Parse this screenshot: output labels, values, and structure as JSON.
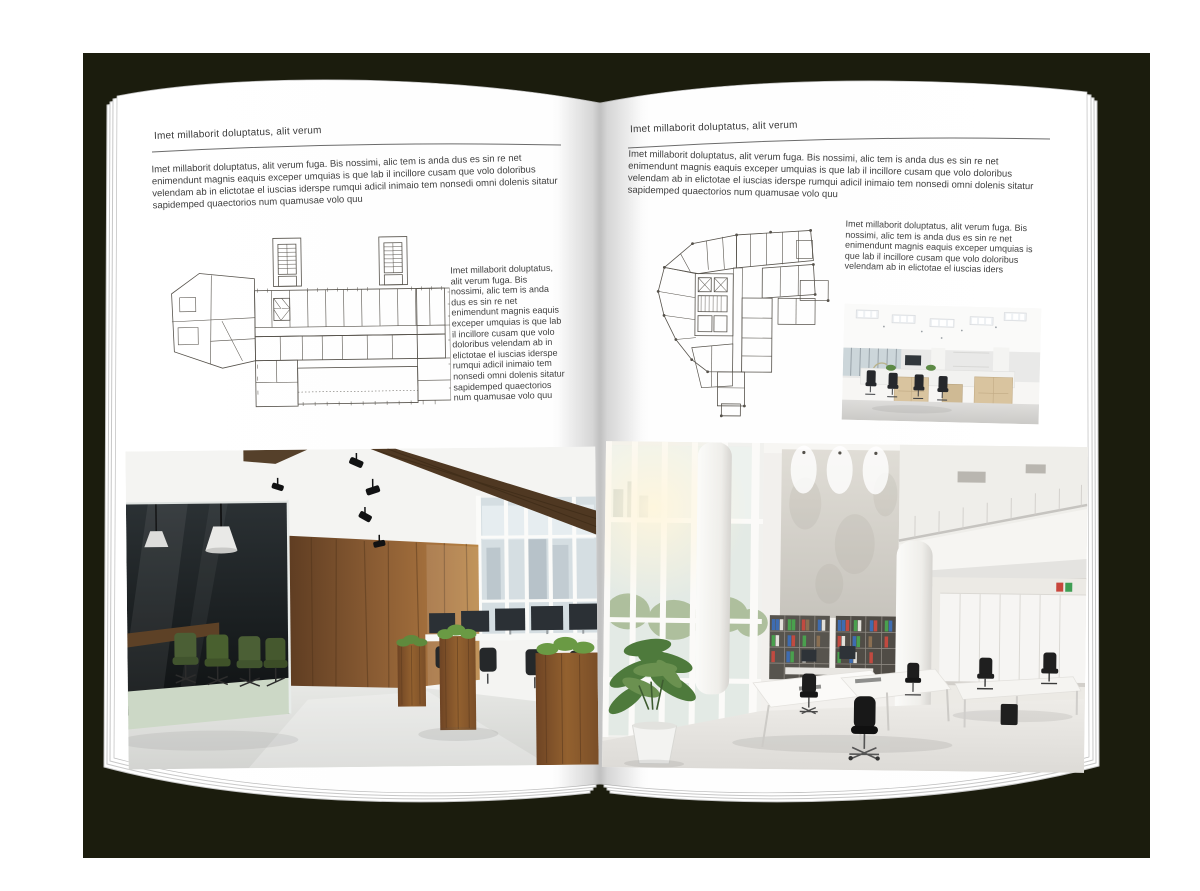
{
  "palette": {
    "backdrop": "#1b1c0d",
    "page": "#ffffff",
    "text": "#3d3d3d",
    "rule": "#6b6b6b",
    "plan_line": "#56524b",
    "wood_wall": "#8a5c33",
    "meeting_room_dark": "#15181a",
    "chair_green": "#4b5f35",
    "grass_green": "#5f8a3d",
    "binder_blue": "#3e6cb1",
    "binder_green": "#4aa04e",
    "binder_red": "#c14a40",
    "floor_light": "#e3e4e1"
  },
  "left_page": {
    "header": "Imet millaborit doluptatus, alit verum",
    "intro": "Imet millaborit doluptatus, alit verum fuga. Bis nossimi, alic tem is anda dus es sin re net enimendunt magnis eaquis exceper umquias is que lab il incillore cusam que volo doloribus velendam ab in elictotae el iuscias iderspe rumqui adicil inimaio tem nonsedi omni dolenis sitatur sapidemped quaectorios num quamusae volo quu",
    "side_text": "Imet millaborit doluptatus, alit verum fuga. Bis nossimi, alic tem is anda dus es sin re net enimendunt magnis eaquis exceper umquias is que lab il incillore cusam que volo doloribus velendam ab in elictotae el iuscias iderspe rumqui adicil inimaio tem nonsedi omni dolenis sitatur sapidemped quaectorios num quamusae volo quu"
  },
  "right_page": {
    "header": "Imet millaborit doluptatus, alit verum",
    "intro": "Imet millaborit doluptatus, alit verum fuga. Bis nossimi, alic tem is anda dus es sin re net enimendunt magnis eaquis exceper umquias is que lab il incillore cusam que volo doloribus velendam ab in elictotae el iuscias iderspe rumqui adicil inimaio tem nonsedi omni dolenis sitatur sapidemped quaectorios num quamusae volo quu",
    "side_text": "Imet millaborit doluptatus, alit verum fuga. Bis nossimi, alic tem is anda dus es sin re net enimendunt magnis eaquis exceper umquias is que lab il incillore cusam que volo doloribus velendam ab in elictotae el iuscias iders"
  }
}
